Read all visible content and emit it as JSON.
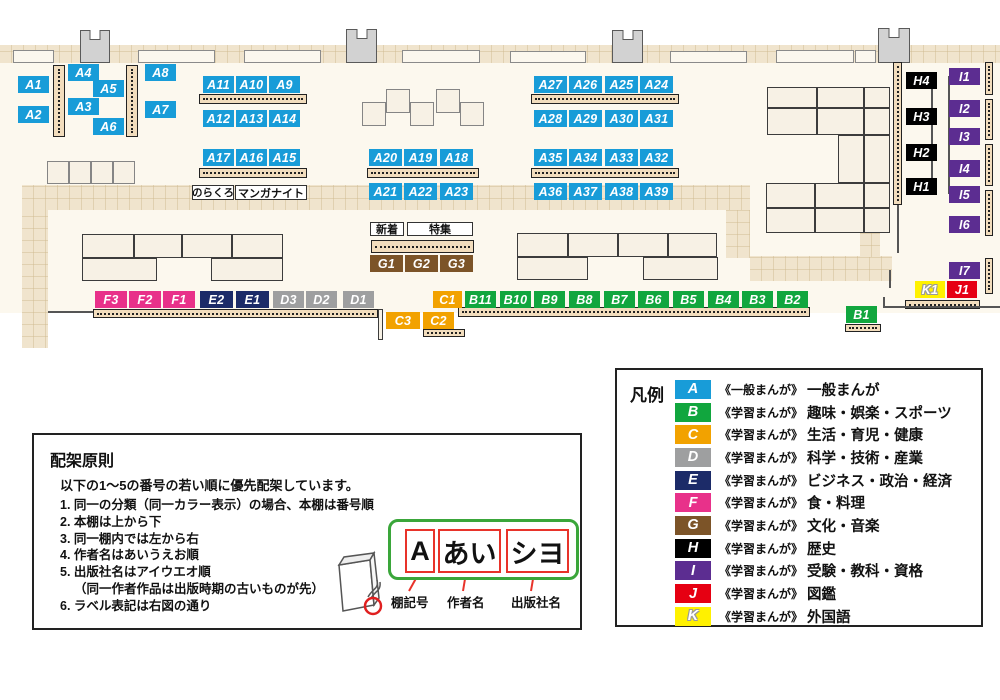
{
  "map": {
    "palette": {
      "A": "#189cd8",
      "B": "#11a63e",
      "C": "#f2a200",
      "D": "#9e9fa0",
      "E": "#1c2b68",
      "F": "#e8318a",
      "G": "#7c5428",
      "H": "#000000",
      "I": "#5c2d91",
      "J": "#e60012",
      "K": "#fff100"
    },
    "floor": [
      0,
      45,
      1000,
      268
    ],
    "walkways": [
      [
        0,
        45,
        1000,
        18
      ],
      [
        22,
        185,
        728,
        25
      ],
      [
        726,
        210,
        24,
        48
      ],
      [
        750,
        256,
        142,
        25
      ],
      [
        860,
        230,
        20,
        27
      ],
      [
        22,
        208,
        26,
        140
      ]
    ],
    "windows": [
      [
        13,
        50,
        41,
        13
      ],
      [
        138,
        50,
        77,
        13
      ],
      [
        244,
        50,
        77,
        13
      ],
      [
        402,
        50,
        78,
        13
      ],
      [
        510,
        51,
        76,
        12
      ],
      [
        670,
        51,
        77,
        12
      ],
      [
        776,
        50,
        78,
        13
      ],
      [
        855,
        50,
        21,
        13
      ]
    ],
    "pillars": [
      [
        80,
        30,
        30,
        33
      ],
      [
        346,
        29,
        31,
        34
      ],
      [
        612,
        30,
        31,
        33
      ],
      [
        878,
        28,
        32,
        35
      ]
    ],
    "shelves": [
      [
        53,
        65,
        12,
        72,
        "v"
      ],
      [
        126,
        65,
        12,
        72,
        "v"
      ],
      [
        893,
        62,
        9,
        143,
        "v"
      ],
      [
        985,
        62,
        8,
        33,
        "v"
      ],
      [
        985,
        99,
        8,
        41,
        "v"
      ],
      [
        985,
        144,
        8,
        42,
        "v"
      ],
      [
        985,
        190,
        8,
        46,
        "v"
      ],
      [
        985,
        258,
        8,
        36,
        "v"
      ],
      [
        199,
        94,
        108,
        10,
        "h"
      ],
      [
        199,
        168,
        108,
        10,
        "h"
      ],
      [
        367,
        168,
        112,
        10,
        "h"
      ],
      [
        531,
        94,
        148,
        10,
        "h"
      ],
      [
        531,
        168,
        148,
        10,
        "h"
      ],
      [
        371,
        240,
        103,
        13,
        "h"
      ],
      [
        93,
        309,
        285,
        9,
        "h"
      ],
      [
        458,
        307,
        352,
        10,
        "h"
      ],
      [
        845,
        324,
        36,
        8,
        "h"
      ],
      [
        423,
        329,
        42,
        8,
        "h"
      ],
      [
        905,
        300,
        75,
        9,
        "h"
      ]
    ],
    "tables": [
      [
        82,
        234,
        52,
        24
      ],
      [
        134,
        234,
        48,
        24
      ],
      [
        182,
        234,
        50,
        24
      ],
      [
        232,
        234,
        51,
        24
      ],
      [
        82,
        258,
        75,
        23
      ],
      [
        211,
        258,
        72,
        23
      ],
      [
        517,
        233,
        51,
        24
      ],
      [
        568,
        233,
        50,
        24
      ],
      [
        618,
        233,
        50,
        24
      ],
      [
        668,
        233,
        49,
        24
      ],
      [
        517,
        257,
        71,
        23
      ],
      [
        643,
        257,
        75,
        23
      ],
      [
        767,
        87,
        50,
        21
      ],
      [
        817,
        87,
        47,
        21
      ],
      [
        864,
        87,
        26,
        21
      ],
      [
        767,
        108,
        50,
        27
      ],
      [
        817,
        108,
        47,
        27
      ],
      [
        864,
        108,
        26,
        27
      ],
      [
        838,
        135,
        26,
        48
      ],
      [
        864,
        135,
        26,
        48
      ],
      [
        766,
        183,
        49,
        25
      ],
      [
        815,
        183,
        49,
        25
      ],
      [
        864,
        183,
        26,
        25
      ],
      [
        766,
        208,
        49,
        25
      ],
      [
        815,
        208,
        49,
        25
      ],
      [
        864,
        208,
        26,
        25
      ],
      [
        378,
        309,
        5,
        31
      ]
    ],
    "squares": [
      [
        47,
        161,
        22,
        23
      ],
      [
        69,
        161,
        22,
        23
      ],
      [
        91,
        161,
        22,
        23
      ],
      [
        113,
        161,
        22,
        23
      ],
      [
        362,
        102,
        24,
        24
      ],
      [
        386,
        89,
        24,
        24
      ],
      [
        410,
        102,
        24,
        24
      ],
      [
        436,
        89,
        24,
        24
      ],
      [
        460,
        102,
        24,
        24
      ]
    ],
    "lines": [
      [
        931,
        80,
        2,
        106
      ],
      [
        948,
        76,
        2,
        118
      ],
      [
        897,
        205,
        2,
        48
      ],
      [
        889,
        270,
        2,
        18
      ],
      [
        883,
        297,
        2,
        10
      ],
      [
        883,
        306,
        14,
        2
      ],
      [
        897,
        306,
        103,
        2
      ],
      [
        48,
        311,
        45,
        2
      ]
    ],
    "labels": [
      {
        "t": "A1",
        "c": "A",
        "x": 18,
        "y": 76,
        "w": 31
      },
      {
        "t": "A2",
        "c": "A",
        "x": 18,
        "y": 106,
        "w": 31
      },
      {
        "t": "A4",
        "c": "A",
        "x": 68,
        "y": 64,
        "w": 31
      },
      {
        "t": "A5",
        "c": "A",
        "x": 93,
        "y": 80,
        "w": 31
      },
      {
        "t": "A3",
        "c": "A",
        "x": 68,
        "y": 98,
        "w": 31
      },
      {
        "t": "A6",
        "c": "A",
        "x": 93,
        "y": 118,
        "w": 31
      },
      {
        "t": "A8",
        "c": "A",
        "x": 145,
        "y": 64,
        "w": 31
      },
      {
        "t": "A7",
        "c": "A",
        "x": 145,
        "y": 101,
        "w": 31
      },
      {
        "t": "A11",
        "c": "A",
        "x": 203,
        "y": 76,
        "w": 31
      },
      {
        "t": "A10",
        "c": "A",
        "x": 236,
        "y": 76,
        "w": 31
      },
      {
        "t": "A9",
        "c": "A",
        "x": 269,
        "y": 76,
        "w": 31
      },
      {
        "t": "A12",
        "c": "A",
        "x": 203,
        "y": 110,
        "w": 31
      },
      {
        "t": "A13",
        "c": "A",
        "x": 236,
        "y": 110,
        "w": 31
      },
      {
        "t": "A14",
        "c": "A",
        "x": 269,
        "y": 110,
        "w": 31
      },
      {
        "t": "A17",
        "c": "A",
        "x": 203,
        "y": 149,
        "w": 31
      },
      {
        "t": "A16",
        "c": "A",
        "x": 236,
        "y": 149,
        "w": 31
      },
      {
        "t": "A15",
        "c": "A",
        "x": 269,
        "y": 149,
        "w": 31
      },
      {
        "t": "A20",
        "c": "A",
        "x": 369,
        "y": 149,
        "w": 33
      },
      {
        "t": "A19",
        "c": "A",
        "x": 404,
        "y": 149,
        "w": 33
      },
      {
        "t": "A18",
        "c": "A",
        "x": 440,
        "y": 149,
        "w": 33
      },
      {
        "t": "A21",
        "c": "A",
        "x": 369,
        "y": 183,
        "w": 33
      },
      {
        "t": "A22",
        "c": "A",
        "x": 404,
        "y": 183,
        "w": 33
      },
      {
        "t": "A23",
        "c": "A",
        "x": 440,
        "y": 183,
        "w": 33
      },
      {
        "t": "A27",
        "c": "A",
        "x": 534,
        "y": 76,
        "w": 33
      },
      {
        "t": "A26",
        "c": "A",
        "x": 569,
        "y": 76,
        "w": 33
      },
      {
        "t": "A25",
        "c": "A",
        "x": 605,
        "y": 76,
        "w": 33
      },
      {
        "t": "A24",
        "c": "A",
        "x": 640,
        "y": 76,
        "w": 33
      },
      {
        "t": "A28",
        "c": "A",
        "x": 534,
        "y": 110,
        "w": 33
      },
      {
        "t": "A29",
        "c": "A",
        "x": 569,
        "y": 110,
        "w": 33
      },
      {
        "t": "A30",
        "c": "A",
        "x": 605,
        "y": 110,
        "w": 33
      },
      {
        "t": "A31",
        "c": "A",
        "x": 640,
        "y": 110,
        "w": 33
      },
      {
        "t": "A35",
        "c": "A",
        "x": 534,
        "y": 149,
        "w": 33
      },
      {
        "t": "A34",
        "c": "A",
        "x": 569,
        "y": 149,
        "w": 33
      },
      {
        "t": "A33",
        "c": "A",
        "x": 605,
        "y": 149,
        "w": 33
      },
      {
        "t": "A32",
        "c": "A",
        "x": 640,
        "y": 149,
        "w": 33
      },
      {
        "t": "A36",
        "c": "A",
        "x": 534,
        "y": 183,
        "w": 33
      },
      {
        "t": "A37",
        "c": "A",
        "x": 569,
        "y": 183,
        "w": 33
      },
      {
        "t": "A38",
        "c": "A",
        "x": 605,
        "y": 183,
        "w": 33
      },
      {
        "t": "A39",
        "c": "A",
        "x": 640,
        "y": 183,
        "w": 33
      },
      {
        "t": "G1",
        "c": "G",
        "x": 370,
        "y": 255,
        "w": 33
      },
      {
        "t": "G2",
        "c": "G",
        "x": 405,
        "y": 255,
        "w": 33
      },
      {
        "t": "G3",
        "c": "G",
        "x": 440,
        "y": 255,
        "w": 33
      },
      {
        "t": "F3",
        "c": "F",
        "x": 95,
        "y": 291,
        "w": 32
      },
      {
        "t": "F2",
        "c": "F",
        "x": 129,
        "y": 291,
        "w": 32
      },
      {
        "t": "F1",
        "c": "F",
        "x": 163,
        "y": 291,
        "w": 32
      },
      {
        "t": "E2",
        "c": "E",
        "x": 200,
        "y": 291,
        "w": 33
      },
      {
        "t": "E1",
        "c": "E",
        "x": 236,
        "y": 291,
        "w": 33
      },
      {
        "t": "D3",
        "c": "D",
        "x": 273,
        "y": 291,
        "w": 31
      },
      {
        "t": "D2",
        "c": "D",
        "x": 306,
        "y": 291,
        "w": 31
      },
      {
        "t": "D1",
        "c": "D",
        "x": 343,
        "y": 291,
        "w": 31
      },
      {
        "t": "C1",
        "c": "C",
        "x": 433,
        "y": 291,
        "w": 29
      },
      {
        "t": "C3",
        "c": "C",
        "x": 386,
        "y": 312,
        "w": 34
      },
      {
        "t": "C2",
        "c": "C",
        "x": 423,
        "y": 312,
        "w": 31
      },
      {
        "t": "B11",
        "c": "B",
        "x": 465,
        "y": 291,
        "w": 31
      },
      {
        "t": "B10",
        "c": "B",
        "x": 500,
        "y": 291,
        "w": 31
      },
      {
        "t": "B9",
        "c": "B",
        "x": 534,
        "y": 291,
        "w": 31
      },
      {
        "t": "B8",
        "c": "B",
        "x": 569,
        "y": 291,
        "w": 31
      },
      {
        "t": "B7",
        "c": "B",
        "x": 604,
        "y": 291,
        "w": 31
      },
      {
        "t": "B6",
        "c": "B",
        "x": 638,
        "y": 291,
        "w": 31
      },
      {
        "t": "B5",
        "c": "B",
        "x": 673,
        "y": 291,
        "w": 31
      },
      {
        "t": "B4",
        "c": "B",
        "x": 708,
        "y": 291,
        "w": 31
      },
      {
        "t": "B3",
        "c": "B",
        "x": 742,
        "y": 291,
        "w": 31
      },
      {
        "t": "B2",
        "c": "B",
        "x": 777,
        "y": 291,
        "w": 31
      },
      {
        "t": "B1",
        "c": "B",
        "x": 846,
        "y": 306,
        "w": 31
      },
      {
        "t": "H4",
        "c": "H",
        "x": 906,
        "y": 72,
        "w": 31
      },
      {
        "t": "H3",
        "c": "H",
        "x": 906,
        "y": 108,
        "w": 31
      },
      {
        "t": "H2",
        "c": "H",
        "x": 906,
        "y": 144,
        "w": 31
      },
      {
        "t": "H1",
        "c": "H",
        "x": 906,
        "y": 178,
        "w": 31
      },
      {
        "t": "I1",
        "c": "I",
        "x": 949,
        "y": 68,
        "w": 31
      },
      {
        "t": "I2",
        "c": "I",
        "x": 949,
        "y": 100,
        "w": 31
      },
      {
        "t": "I3",
        "c": "I",
        "x": 949,
        "y": 128,
        "w": 31
      },
      {
        "t": "I4",
        "c": "I",
        "x": 949,
        "y": 160,
        "w": 31
      },
      {
        "t": "I5",
        "c": "I",
        "x": 949,
        "y": 186,
        "w": 31
      },
      {
        "t": "I6",
        "c": "I",
        "x": 949,
        "y": 216,
        "w": 31
      },
      {
        "t": "I7",
        "c": "I",
        "x": 949,
        "y": 262,
        "w": 31
      },
      {
        "t": "K1",
        "c": "K",
        "x": 915,
        "y": 281,
        "w": 30
      },
      {
        "t": "J1",
        "c": "J",
        "x": 947,
        "y": 281,
        "w": 30
      }
    ],
    "tags": [
      {
        "t": "のらくろ",
        "x": 192,
        "y": 185,
        "w": 42,
        "h": 15,
        "fs": 10.5
      },
      {
        "t": "マンガナイト",
        "x": 235,
        "y": 185,
        "w": 72,
        "h": 15,
        "fs": 11
      },
      {
        "t": "新着",
        "x": 370,
        "y": 222,
        "w": 34,
        "h": 14,
        "fs": 11
      },
      {
        "t": "特集",
        "x": 407,
        "y": 222,
        "w": 66,
        "h": 14,
        "fs": 11
      }
    ]
  },
  "legend": {
    "title": "凡例",
    "items": [
      {
        "key": "A",
        "letter": "A",
        "series": "《一般まんが》",
        "category": "一般まんが"
      },
      {
        "key": "B",
        "letter": "B",
        "series": "《学習まんが》",
        "category": "趣味・娯楽・スポーツ"
      },
      {
        "key": "C",
        "letter": "C",
        "series": "《学習まんが》",
        "category": "生活・育児・健康"
      },
      {
        "key": "D",
        "letter": "D",
        "series": "《学習まんが》",
        "category": "科学・技術・産業"
      },
      {
        "key": "E",
        "letter": "E",
        "series": "《学習まんが》",
        "category": "ビジネス・政治・経済"
      },
      {
        "key": "F",
        "letter": "F",
        "series": "《学習まんが》",
        "category": "食・料理"
      },
      {
        "key": "G",
        "letter": "G",
        "series": "《学習まんが》",
        "category": "文化・音楽"
      },
      {
        "key": "H",
        "letter": "H",
        "series": "《学習まんが》",
        "category": "歴史"
      },
      {
        "key": "I",
        "letter": "I",
        "series": "《学習まんが》",
        "category": "受験・教科・資格"
      },
      {
        "key": "J",
        "letter": "J",
        "series": "《学習まんが》",
        "category": "図鑑"
      },
      {
        "key": "K",
        "letter": "K",
        "series": "《学習まんが》",
        "category": "外国語"
      }
    ]
  },
  "principles": {
    "title": "配架原則",
    "intro": "以下の1～5の番号の若い順に優先配架しています。",
    "items": [
      {
        "text": "1. 同一の分類（同一カラー表示）の場合、本棚は番号順",
        "indent": false
      },
      {
        "text": "2. 本棚は上から下",
        "indent": false
      },
      {
        "text": "3. 同一棚内では左から右",
        "indent": false
      },
      {
        "text": "4. 作者名はあいうえお順",
        "indent": false
      },
      {
        "text": "5. 出版社名はアイウエオ順",
        "indent": false
      },
      {
        "text": "（同一作者作品は出版時期の古いものが先）",
        "indent": true
      },
      {
        "text": "6. ラベル表記は右図の通り",
        "indent": false
      }
    ],
    "diagram": {
      "shelf_code": "A",
      "author": "あい",
      "publisher": "シヨ",
      "shelf_code_label": "棚記号",
      "author_label": "作者名",
      "publisher_label": "出版社名"
    }
  }
}
